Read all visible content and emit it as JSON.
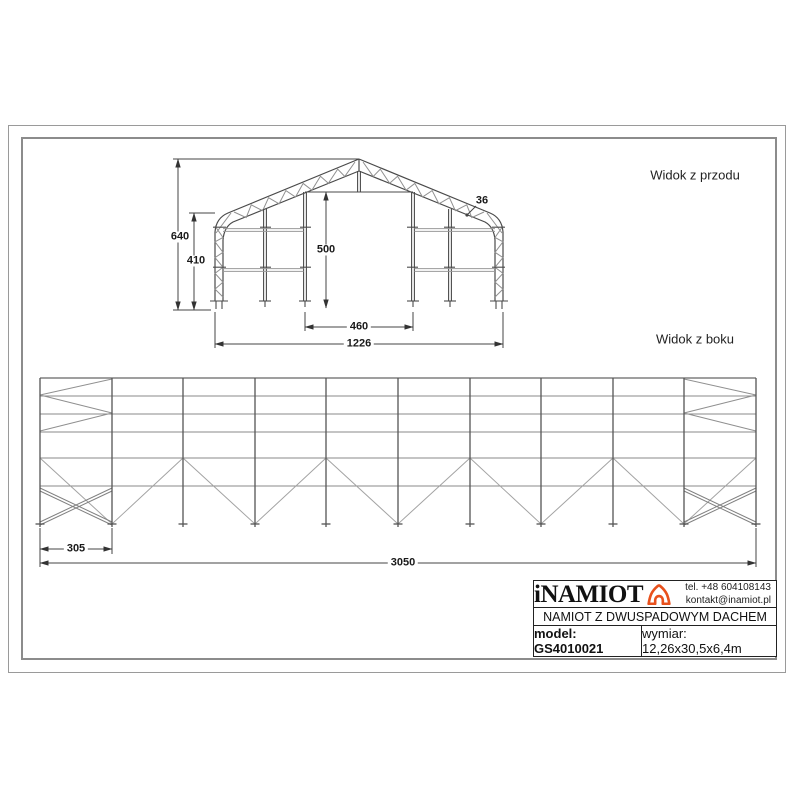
{
  "sheet": {
    "front_view_label": "Widok z przodu",
    "side_view_label": "Widok z boku"
  },
  "front_dims": {
    "total_height": "640",
    "wall_height": "410",
    "door_height": "500",
    "door_width": "460",
    "total_width": "1226",
    "truss_depth": "36"
  },
  "side_dims": {
    "bay_spacing": "305",
    "total_length": "3050"
  },
  "title_block": {
    "brand": "iNAMIOT",
    "phone": "tel. +48 604108143",
    "email": "kontakt@inamiot.pl",
    "product_name": "NAMIOT Z DWUSPADOWYM DACHEM",
    "model": "model: GS4010021",
    "size": "wymiar: 12,26x30,5x6,4m"
  },
  "colors": {
    "accent": "#E8511D",
    "line_dark": "#4a4a4a",
    "line_light": "#8f8f8f"
  }
}
